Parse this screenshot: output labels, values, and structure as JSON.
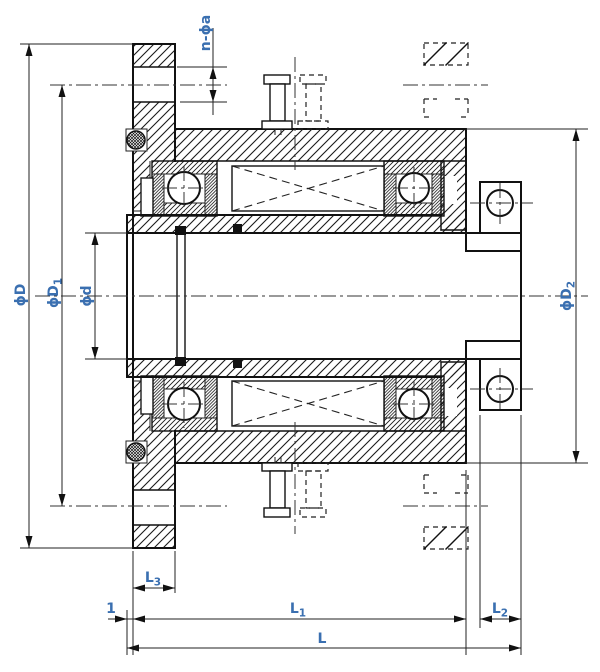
{
  "colors": {
    "line": "#111111",
    "dim_text": "#3a6fb0",
    "background": "#ffffff"
  },
  "dims": {
    "n_phi_a": "n-ϕa",
    "phi_D": "ϕD",
    "phi_D1_main": "ϕD",
    "phi_D1_sub": "1",
    "phi_d": "ϕd",
    "phi_D2_main": "ϕD",
    "phi_D2_sub": "2",
    "L3_main": "L",
    "L3_sub": "3",
    "one": "1",
    "L1_main": "L",
    "L1_sub": "1",
    "L2_main": "L",
    "L2_sub": "2",
    "L": "L"
  }
}
